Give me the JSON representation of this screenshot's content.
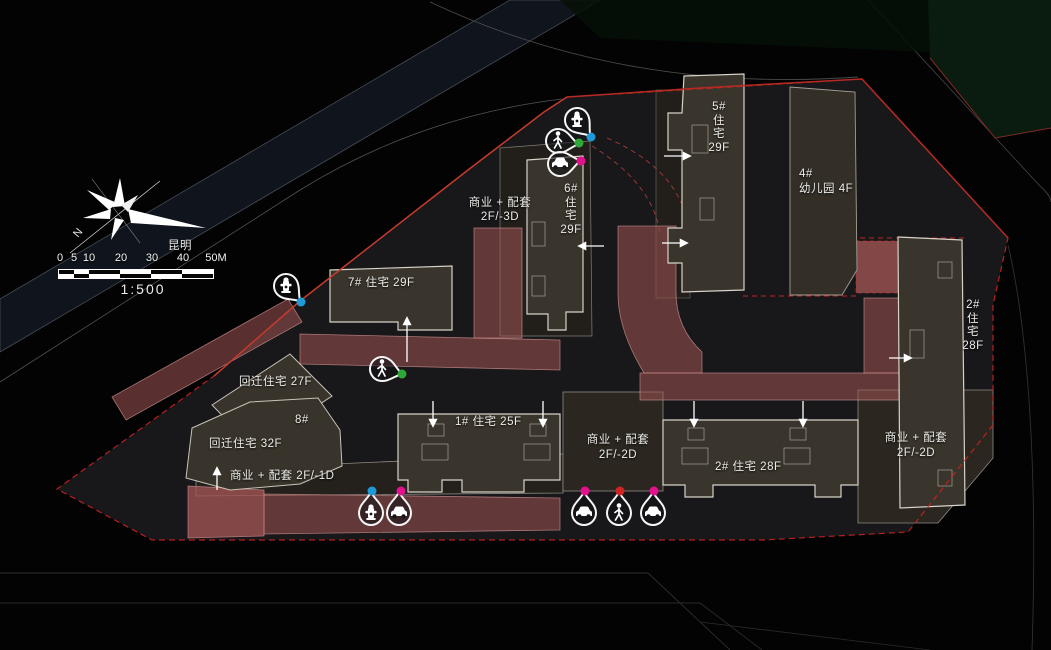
{
  "plan": {
    "location_label": "昆明",
    "scale": {
      "ratio": "1:500",
      "ticks": [
        "0",
        "5",
        "10",
        "20",
        "30",
        "40",
        "50M"
      ]
    },
    "compass": {
      "north": "N"
    }
  },
  "labels": {
    "b5": "5#\n住\n宅\n29F",
    "b4": "4#\n幼儿园 4F",
    "biz_3d": "商业 + 配套\n2F/-3D",
    "b6": "6#\n住\n宅\n29F",
    "b7": "7# 住宅 29F",
    "hq27": "回迁住宅 27F",
    "b8": "8#",
    "hq32": "回迁住宅 32F",
    "biz_1d": "商业 + 配套 2F/-1D",
    "b1": "1# 住宅 25F",
    "biz_2d_mid": "商业 + 配套\n2F/-2D",
    "b2_south": "2# 住宅 28F",
    "biz_2d_east": "商业 + 配套\n2F/-2D",
    "b2_east": "2#\n住\n宅\n28F"
  },
  "pins": [
    {
      "location": "north-entry",
      "type": "fire-hydrant",
      "dot_color": "#1f9ad6"
    },
    {
      "location": "north-entry",
      "type": "pedestrian",
      "dot_color": "#2ea836"
    },
    {
      "location": "north-entry",
      "type": "car",
      "dot_color": "#e3118e"
    },
    {
      "location": "northwest",
      "type": "fire-hydrant",
      "dot_color": "#1f9ad6"
    },
    {
      "location": "west",
      "type": "pedestrian",
      "dot_color": "#2ea836"
    },
    {
      "location": "southwest",
      "type": "fire-hydrant",
      "dot_color": "#1f9ad6"
    },
    {
      "location": "southwest",
      "type": "car",
      "dot_color": "#e3118e"
    },
    {
      "location": "south",
      "type": "car",
      "dot_color": "#e3118e"
    },
    {
      "location": "south",
      "type": "pedestrian",
      "dot_color": "#d02424"
    },
    {
      "location": "south",
      "type": "car",
      "dot_color": "#e3118e"
    }
  ],
  "colors": {
    "boundary_red": "#c92222",
    "fire_lane_red": "#a05454",
    "building_fill": "#3a352c",
    "building_outline": "#d6d2c8",
    "site_ground": "#18171a",
    "dot_blue": "#1f9ad6",
    "dot_green": "#2ea836",
    "dot_magenta": "#e3118e",
    "dot_red": "#d02424"
  }
}
